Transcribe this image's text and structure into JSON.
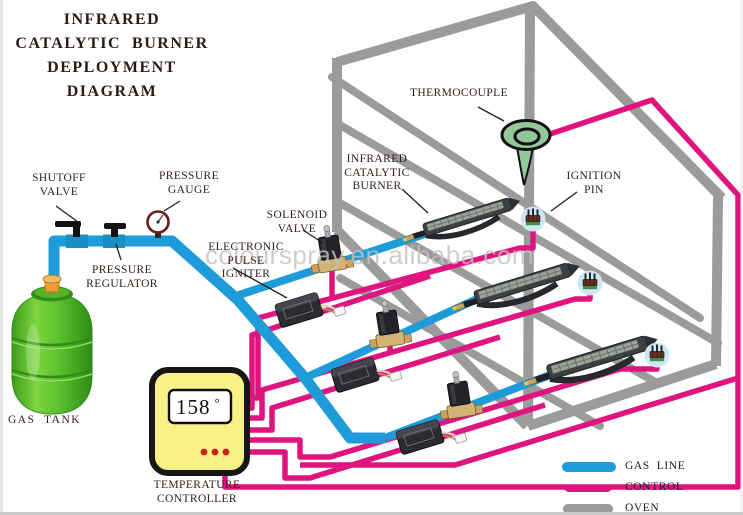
{
  "title": "INFRARED\nCATALYTIC  BURNER\nDEPLOYMENT\nDIAGRAM",
  "watermark": "colourspray.en.alibaba.com",
  "labels": {
    "shutoff_valve": "SHUTOFF\nVALVE",
    "pressure_gauge": "PRESSURE\nGAUGE",
    "pressure_regulator": "PRESSURE\nREGULATOR",
    "electronic_pulse_igniter": "ELECTRONIC\nPULSE\nIGNITER",
    "solenoid_valve": "SOLENOID\nVALVE",
    "infrared_catalytic_burner": "INFRARED\nCATALYTIC\nBURNER",
    "thermocouple": "THERMOCOUPLE",
    "ignition_pin": "IGNITION\nPIN",
    "gas_tank": "GAS  TANK",
    "temperature_controller": "TEMPERATURE\nCONTROLLER"
  },
  "controller_display": {
    "reading": "158",
    "unit": "°"
  },
  "legend": {
    "items": [
      {
        "label": "GAS  LINE",
        "color": "#1e9cd9"
      },
      {
        "label": "CONTROL",
        "color": "#e0147f"
      },
      {
        "label": "OVEN",
        "color": "#9b9b9b"
      }
    ]
  },
  "colors": {
    "gas_line": "#1e9cd9",
    "control": "#e0147f",
    "oven": "#9b9b9b",
    "thermocouple": "#93c89b",
    "controller_body": "#f8f286",
    "tank_green": "#5cb82e",
    "leader": "#1f1f1f"
  }
}
